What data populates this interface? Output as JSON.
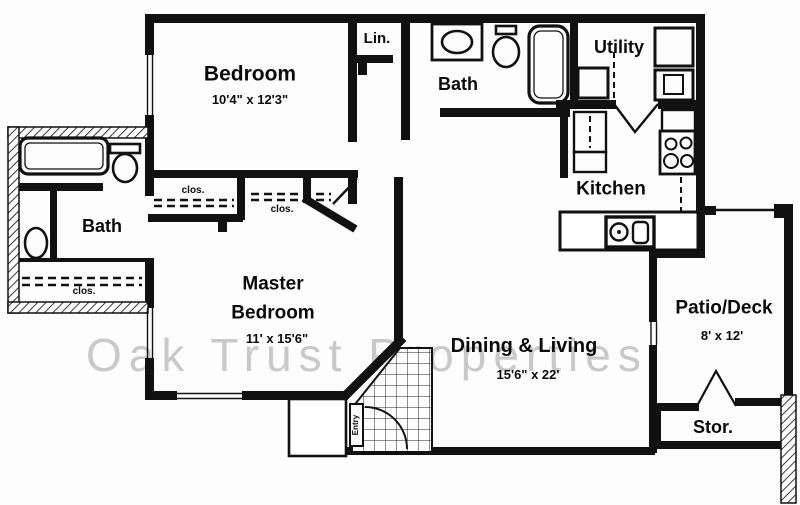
{
  "watermark": "Oak Trust Properties",
  "colors": {
    "wall": "#111111",
    "watermark": "#c9c9c9",
    "background": "#fdfdfd"
  },
  "rooms": {
    "bedroom": {
      "name": "Bedroom",
      "dims": "10'4\" x 12'3\""
    },
    "linen": {
      "name": "Lin."
    },
    "bath_top": {
      "name": "Bath"
    },
    "utility": {
      "name": "Utility"
    },
    "kitchen": {
      "name": "Kitchen"
    },
    "bath_left": {
      "name": "Bath"
    },
    "master_bedroom": {
      "name": "Master Bedroom",
      "dims": "11' x 15'6\""
    },
    "dining_living": {
      "name": "Dining & Living",
      "dims": "15'6\" x 22'"
    },
    "patio": {
      "name": "Patio/Deck",
      "dims": "8' x 12'"
    },
    "storage": {
      "name": "Stor."
    },
    "entry": {
      "name": "Entry"
    }
  },
  "closets": {
    "bedroom_closet": "clos.",
    "master_closet": "clos.",
    "bath_closet": "clos."
  }
}
